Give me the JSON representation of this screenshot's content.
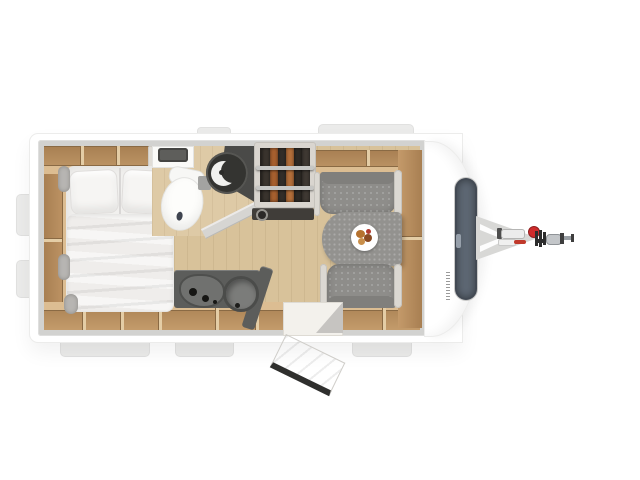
{
  "page": {
    "background": "#ffffff",
    "description": "Top-down 3D rendered floor plan of a single-axle travel caravan with hitch pointing right"
  },
  "caravan": {
    "colors": {
      "body": "#ffffff",
      "walls": "#d2d2d0",
      "floor_wood": "#d8c29a",
      "cabinet_wood": "#c39b6b",
      "upholstery_gray": "#8e8d8a",
      "counter_dark": "#5c5d5b",
      "window_glass": "#5d6773",
      "accent_red": "#cf2b2b"
    },
    "areas": {
      "bed": {
        "label": "Double bed with two pillows and folded duvet"
      },
      "bathroom": {
        "label": "Washroom with toilet, corner washbasin, shower enclosure and mirror shelf"
      },
      "wardrobe": {
        "label": "Wardrobe with clothes hanging on two rails"
      },
      "kitchen": {
        "label": "Kitchen block with hob, round sink and drawers"
      },
      "dinette": {
        "label": "Front dinette with two facing bench seats and table"
      },
      "table_plate": {
        "label": "Plate with food on the dinette table"
      },
      "entry_door": {
        "label": "Entry door shown open on the lower wall"
      },
      "front_window": {
        "label": "Front panoramic window in the bodywork"
      },
      "hitch": {
        "label": "A-frame drawbar with jockey-wheel handle, red knob and coupling head"
      },
      "storage_rear_wall": {
        "label": "Overhead storage lockers along the upper wall"
      },
      "storage_door_wall": {
        "label": "Storage lockers along the lower wall"
      },
      "sideboard": {
        "label": "Wooden sideboard shelf at the front wall"
      },
      "brand_marking": {
        "label": "Small vertical brand lettering on the bodywork (illegible)"
      }
    }
  }
}
